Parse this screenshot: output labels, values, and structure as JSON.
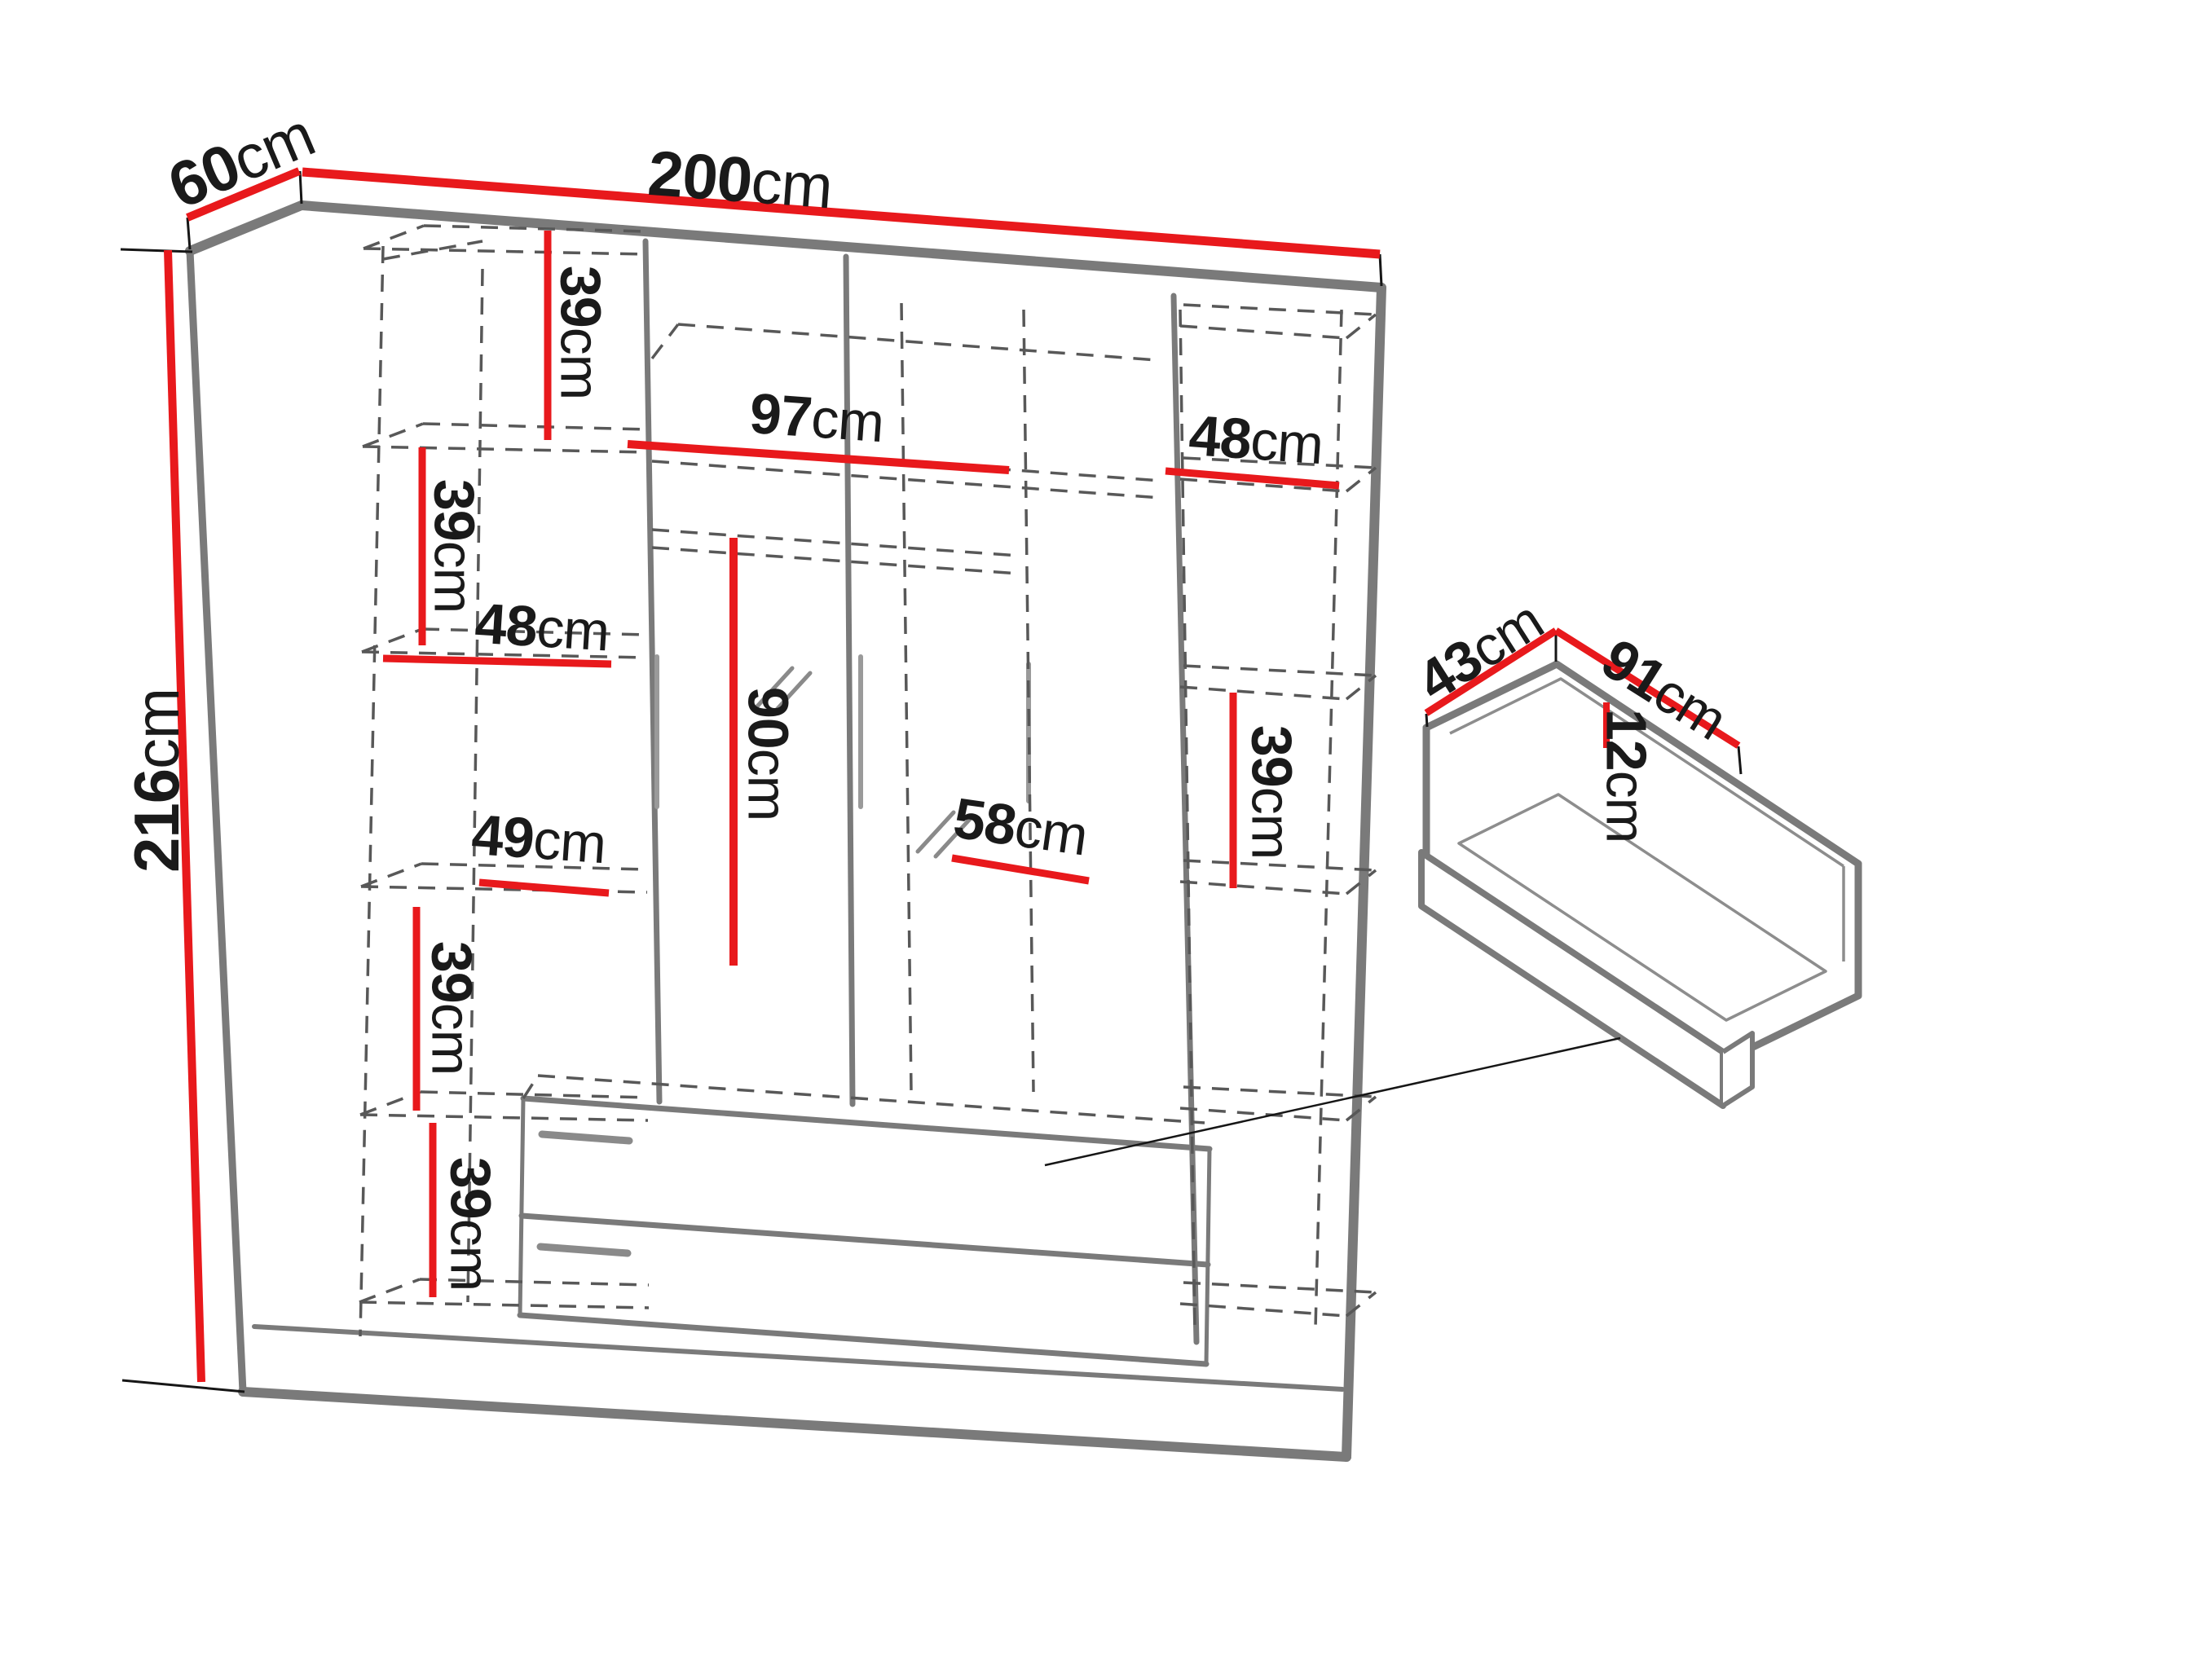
{
  "colors": {
    "dimension_red": "#e8191c",
    "outline_gray": "#7a7a7a",
    "dashed_gray": "#585858",
    "detail_gray": "#9a9a9a",
    "text_black": "#1a1a1a",
    "background": "#ffffff"
  },
  "wardrobe": {
    "overall": {
      "width": {
        "value": "200",
        "unit": "cm"
      },
      "depth": {
        "value": "60",
        "unit": "cm"
      },
      "height": {
        "value": "216",
        "unit": "cm"
      }
    },
    "left_column": {
      "shelf_top": {
        "value": "39",
        "unit": "cm"
      },
      "shelf_upper": {
        "value": "39",
        "unit": "cm"
      },
      "width_upper": {
        "value": "48",
        "unit": "cm"
      },
      "width_mid": {
        "value": "49",
        "unit": "cm"
      },
      "shelf_lower": {
        "value": "39",
        "unit": "cm"
      },
      "shelf_bottom": {
        "value": "39",
        "unit": "cm"
      }
    },
    "middle_section": {
      "top_width": {
        "value": "97",
        "unit": "cm"
      },
      "door_height": {
        "value": "90",
        "unit": "cm"
      },
      "drawer_width": {
        "value": "58",
        "unit": "cm"
      }
    },
    "right_column": {
      "width": {
        "value": "48",
        "unit": "cm"
      },
      "shelf": {
        "value": "39",
        "unit": "cm"
      }
    }
  },
  "drawer_detail": {
    "depth": {
      "value": "43",
      "unit": "cm"
    },
    "width": {
      "value": "91",
      "unit": "cm"
    },
    "height": {
      "value": "12",
      "unit": "cm"
    }
  }
}
